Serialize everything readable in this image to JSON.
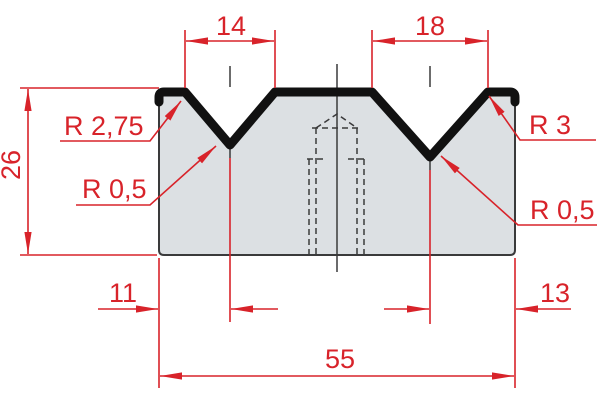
{
  "drawing": {
    "type": "technical-drawing",
    "subject": "2-V press brake die cross-section",
    "colors": {
      "dimension_red": "#d8232a",
      "body_fill": "#dce0e3",
      "body_outline": "#3a3a3b",
      "top_band": "#111111"
    },
    "dimensions": {
      "v1_opening": "14",
      "v2_opening": "18",
      "body_height": "26",
      "v1_center_offset": "11",
      "v2_center_offset": "13",
      "total_width": "55"
    },
    "radius_labels": {
      "v1_shoulder": "R 2,75",
      "v1_bottom": "R 0,5",
      "v2_shoulder": "R 3",
      "v2_bottom": "R 0,5"
    }
  }
}
